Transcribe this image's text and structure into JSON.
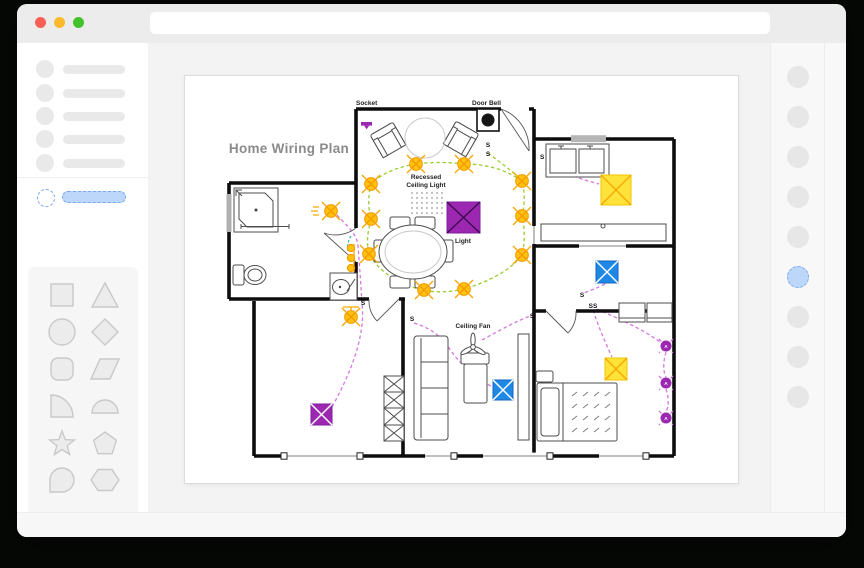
{
  "window": {
    "buttons": [
      "close",
      "minimize",
      "zoom"
    ],
    "search_value": ""
  },
  "sidebar": {
    "placeholder_items": 5,
    "selected_item_index": 6,
    "shape_palette": [
      "square",
      "triangle",
      "circle",
      "diamond",
      "rounded-square",
      "parallelogram",
      "quarter-circle",
      "semicircle",
      "star",
      "pentagon",
      "teardrop",
      "hexagon"
    ]
  },
  "right_panel": {
    "dot_count": 9,
    "active_dot_index": 6
  },
  "plan": {
    "title": "Home Wiring Plan",
    "labels": {
      "socket": "Socket",
      "door_bell": "Door Bell",
      "recessed_1": "Recessed",
      "recessed_2": "Ceiling Light",
      "light": "Light",
      "ceiling_fan": "Ceiling Fan",
      "switch": "S",
      "switch_double": "SS",
      "outlet_a": "A"
    },
    "symbol_counts": {
      "recessed_ceiling_lights": 10,
      "wall_lamps": 3,
      "purple_ceiling_lights": 2,
      "yellow_ceiling_lights": 2,
      "blue_fan_units": 2,
      "outlet_a_circles": 3
    }
  },
  "colors": {
    "traffic_red": "#fa5f55",
    "traffic_yellow": "#fbba2c",
    "traffic_green": "#43c32b",
    "select_blue_fill": "#bcd7fa",
    "select_blue_border": "#7aa9ee",
    "wire_green": "#9ACD32",
    "wire_magenta": "#D678DE",
    "wire_teal": "#26B5A8",
    "light_yellow": "#FFC20E",
    "light_orange": "#F59B00",
    "fixture_purple": "#9C27B0",
    "fixture_blue": "#1E88E5",
    "fixture_yellow": "#FFE33A"
  }
}
